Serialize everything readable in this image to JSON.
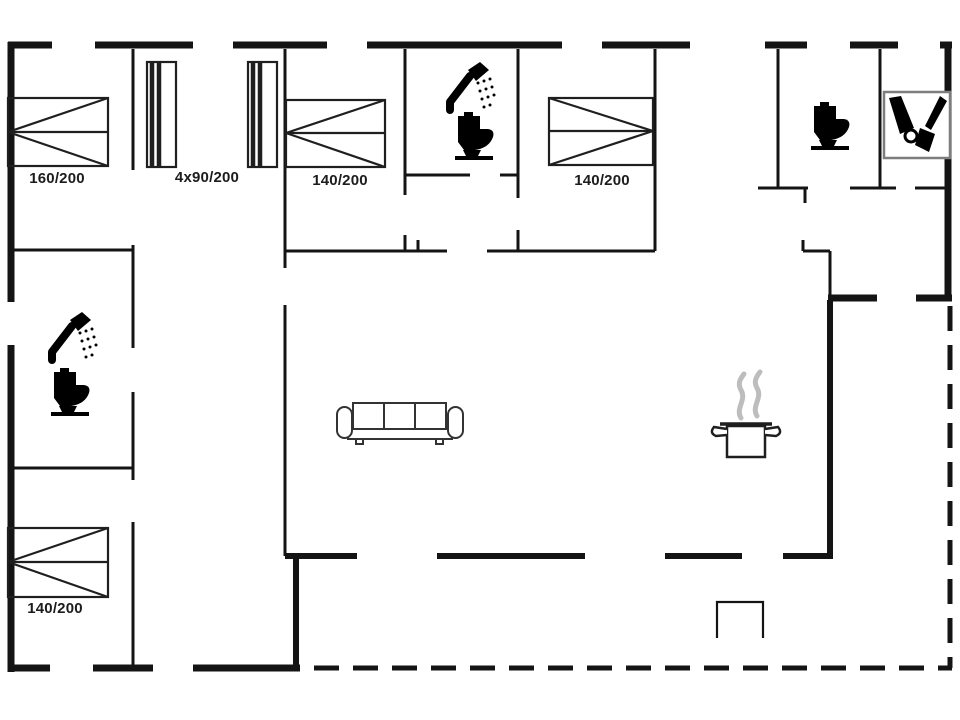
{
  "plan": {
    "bed_labels": [
      {
        "room": "bedroom-top-left",
        "size": "160/200"
      },
      {
        "room": "bedroom-bunks",
        "size": "4x90/200"
      },
      {
        "room": "bedroom-top-middle",
        "size": "140/200"
      },
      {
        "room": "bedroom-top-right",
        "size": "140/200"
      },
      {
        "room": "bedroom-bottom-left",
        "size": "140/200"
      }
    ],
    "icons": [
      "shower-icon (top bathroom)",
      "toilet-icon (top bathroom)",
      "toilet-icon (right wc)",
      "cleaning-equipment-icon (utility room)",
      "shower-icon (left bathroom)",
      "toilet-icon (left bathroom)",
      "sofa-icon (living room)",
      "cooking-pot-icon (kitchen)",
      "terrace-step"
    ],
    "colors": {
      "wall": "#141414",
      "background": "#ffffff",
      "furniture_line": "#1f1f1f",
      "steam": "#bdbdbd",
      "equipment_box_border": "#7d7d7d"
    }
  }
}
